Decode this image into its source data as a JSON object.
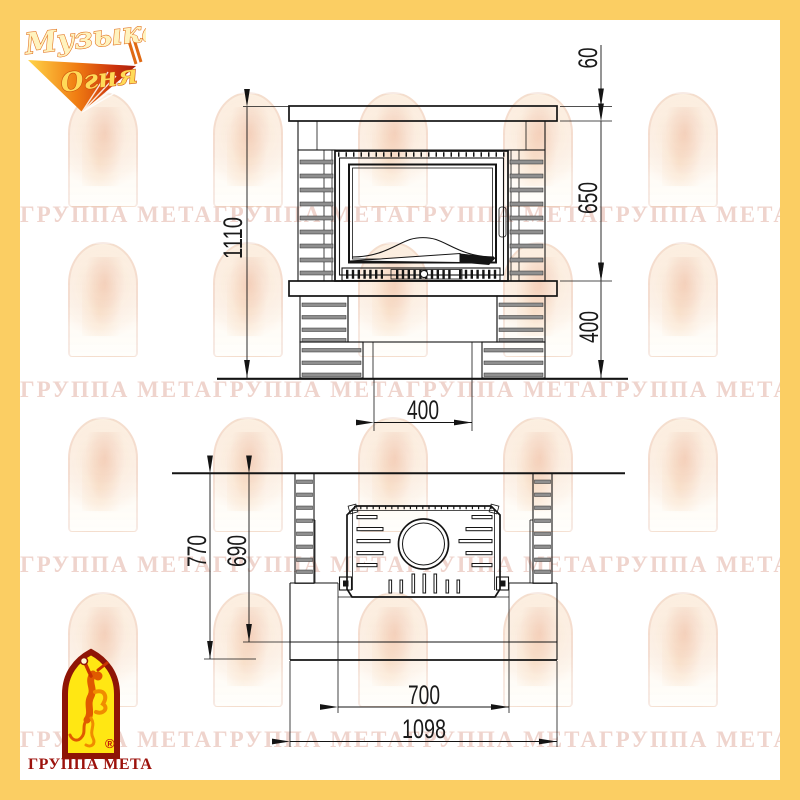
{
  "page": {
    "border_color": "#FBCE63"
  },
  "branding": {
    "logo_top": {
      "line1": "Музыка",
      "line2": "Огня"
    },
    "logo_bottom": {
      "caption": "ГРУППА МЕТА",
      "registered": "®"
    }
  },
  "watermark": {
    "row_text": "ГРУППА МЕТАГРУППА МЕТАГРУППА МЕТАГРУППА МЕТАГРУППА МЕТАГРУППА МЕТА"
  },
  "drawing": {
    "front": {
      "dim_shelf_height": "60",
      "dim_opening_height": "650",
      "dim_base_height": "400",
      "dim_total_height": "1110",
      "dim_niche_width": "400"
    },
    "plan": {
      "dim_total_depth": "770",
      "dim_base_depth": "690",
      "dim_front_width": "700",
      "dim_total_width": "1098"
    }
  }
}
